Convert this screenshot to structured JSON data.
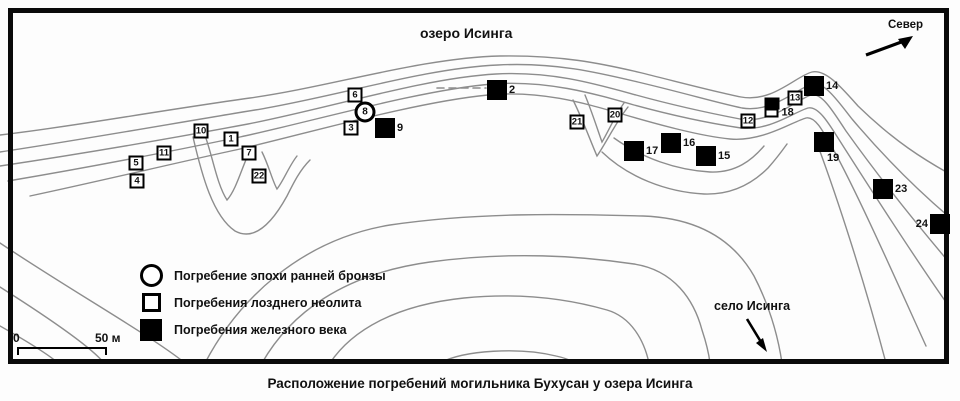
{
  "map": {
    "lake_label": "озеро Исинга",
    "north_label": "Север",
    "village_label": "село Исинга",
    "caption": "Расположение погребений могильника Бухусан у озера Исинга"
  },
  "legend": {
    "items": [
      {
        "type": "circle",
        "label": "Погребение эпохи ранней бронзы"
      },
      {
        "type": "open",
        "label": "Погребения лозднего неолита"
      },
      {
        "type": "filled",
        "label": "Погребения железного века"
      }
    ]
  },
  "scale_bar": {
    "start": "0",
    "end": "50 м"
  },
  "colors": {
    "contour": "#8d8d8d",
    "marker": "#000000",
    "background": "#fdfdfd"
  },
  "markers": [
    {
      "number": "1",
      "type": "open",
      "x": 231,
      "y": 139
    },
    {
      "number": "2",
      "type": "filled",
      "x": 497,
      "y": 90,
      "label_side": "right"
    },
    {
      "number": "3",
      "type": "open",
      "x": 351,
      "y": 128
    },
    {
      "number": "4",
      "type": "open",
      "x": 137,
      "y": 181
    },
    {
      "number": "5",
      "type": "open",
      "x": 136,
      "y": 163
    },
    {
      "number": "6",
      "type": "open",
      "x": 355,
      "y": 95
    },
    {
      "number": "7",
      "type": "open",
      "x": 249,
      "y": 153
    },
    {
      "number": "8",
      "type": "circle",
      "x": 365,
      "y": 112
    },
    {
      "number": "9",
      "type": "filled",
      "x": 385,
      "y": 128,
      "label_side": "right"
    },
    {
      "number": "10",
      "type": "open",
      "x": 201,
      "y": 131
    },
    {
      "number": "11",
      "type": "open",
      "x": 164,
      "y": 153
    },
    {
      "number": "12",
      "type": "open",
      "x": 748,
      "y": 121
    },
    {
      "number": "13",
      "type": "open",
      "x": 795,
      "y": 98
    },
    {
      "number": "14",
      "type": "filled",
      "x": 814,
      "y": 86,
      "label_side": "right"
    },
    {
      "number": "15",
      "type": "filled",
      "x": 706,
      "y": 156,
      "label_side": "right"
    },
    {
      "number": "16",
      "type": "filled",
      "x": 671,
      "y": 143,
      "label_side": "right"
    },
    {
      "number": "17",
      "type": "filled",
      "x": 634,
      "y": 151,
      "label_side": "right"
    },
    {
      "number": "18",
      "type": "combo",
      "x": 772,
      "y": 108,
      "label_side": "right"
    },
    {
      "number": "19",
      "type": "filled",
      "x": 824,
      "y": 142,
      "label_side": "below-right"
    },
    {
      "number": "20",
      "type": "open",
      "x": 615,
      "y": 115
    },
    {
      "number": "21",
      "type": "open",
      "x": 577,
      "y": 122
    },
    {
      "number": "22",
      "type": "open",
      "x": 259,
      "y": 176
    },
    {
      "number": "23",
      "type": "filled",
      "x": 883,
      "y": 189,
      "label_side": "right"
    },
    {
      "number": "24",
      "type": "filled",
      "x": 940,
      "y": 224,
      "label_side": "left"
    }
  ]
}
